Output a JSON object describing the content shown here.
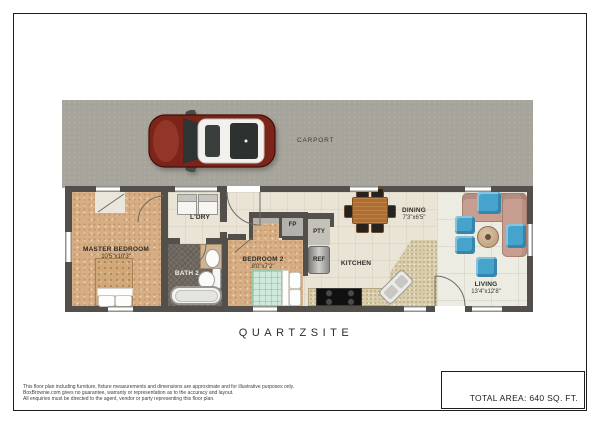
{
  "meta": {
    "title_label": "QUARTZSITE",
    "total_area": "TOTAL AREA: 640 SQ. FT."
  },
  "carport": {
    "label": "CARPORT"
  },
  "rooms": {
    "master": {
      "label": "MASTER BEDROOM",
      "dims": "10'5\"x10'3\""
    },
    "laundry": {
      "label": "L'DRY"
    },
    "bath2": {
      "label": "BATH 2"
    },
    "bedroom2": {
      "label": "BEDROOM 2",
      "dims": "8'0\"x7'2\""
    },
    "fp": {
      "label": "FP"
    },
    "pty": {
      "label": "PTY"
    },
    "ref": {
      "label": "REF"
    },
    "kitchen": {
      "label": "KITCHEN"
    },
    "dining": {
      "label": "DINING",
      "dims": "7'3\"x6'5\""
    },
    "living": {
      "label": "LIVING",
      "dims": "13'4\"x12'8\""
    }
  },
  "disclaimer": {
    "line1": "This floor plan including furniture, fixture measurements and dimensions are approximate and for illustrative purposes only.",
    "line2": "BoxBrownie.com gives no guarantee, warranty or representation as to the accuracy and layout.",
    "line3": "All enquiries must be directed to the agent, vendor or party representing this floor plan."
  },
  "colors": {
    "carport_concrete": "#a6a49b",
    "wall": "#534f4a",
    "carpet_tan": "#d7ae84",
    "tile_cream": "#e9e4d5",
    "living_tile": "#edece3",
    "bath_tile": "#6f6860",
    "counter_granite": "#d9cca9",
    "accent_blue": "#45a3cc",
    "sofa_rose": "#c89e90",
    "car_red": "#7c241a",
    "bed2_mint": "#cdeadb"
  }
}
